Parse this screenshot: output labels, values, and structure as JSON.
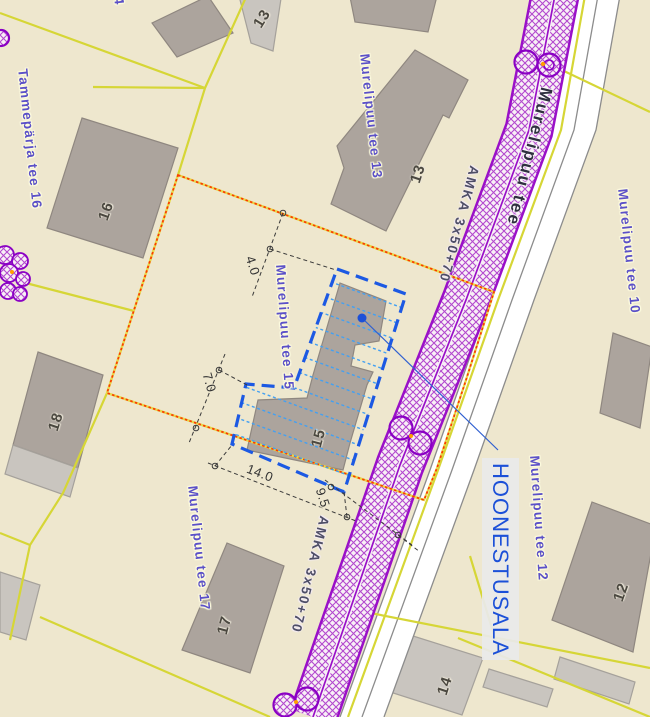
{
  "map": {
    "parcel_labels": {
      "tammeparja_16": "Tammepärja tee 16",
      "murelipuu_13": "Murelipuu tee 13",
      "murelipuu_15": "Murelipuu tee 15",
      "murelipuu_10": "Murelipuu tee 10",
      "murelipuu_12": "Murelipuu tee 12",
      "murelipuu_17": "Murelipuu tee 17",
      "edge_fragment": "4"
    },
    "street_name": "Murelipuu tee",
    "powerline_label": "AMKA 3x50+70",
    "annotation_label": "HOONESTUSALA",
    "building_numbers": {
      "b16": "16",
      "b13": "13",
      "b13_annex": "13",
      "b18": "18",
      "b15": "15",
      "b17": "17",
      "b12": "12",
      "b14": "14"
    },
    "dimensions": {
      "north": "4.0",
      "west": "7.0",
      "south": "14.0",
      "road": "9.5"
    },
    "colors": {
      "background": "#EEE7CE",
      "cadastral_line": "#D6D636",
      "corridor": "#9A10C8",
      "selection_outline": "#FB3B00",
      "building_area_outline": "#1C59E3",
      "building_area_hatch": "#43A0F2",
      "annotation_text": "#1C50D8",
      "parcel_label_text": "#5B50C8"
    }
  }
}
